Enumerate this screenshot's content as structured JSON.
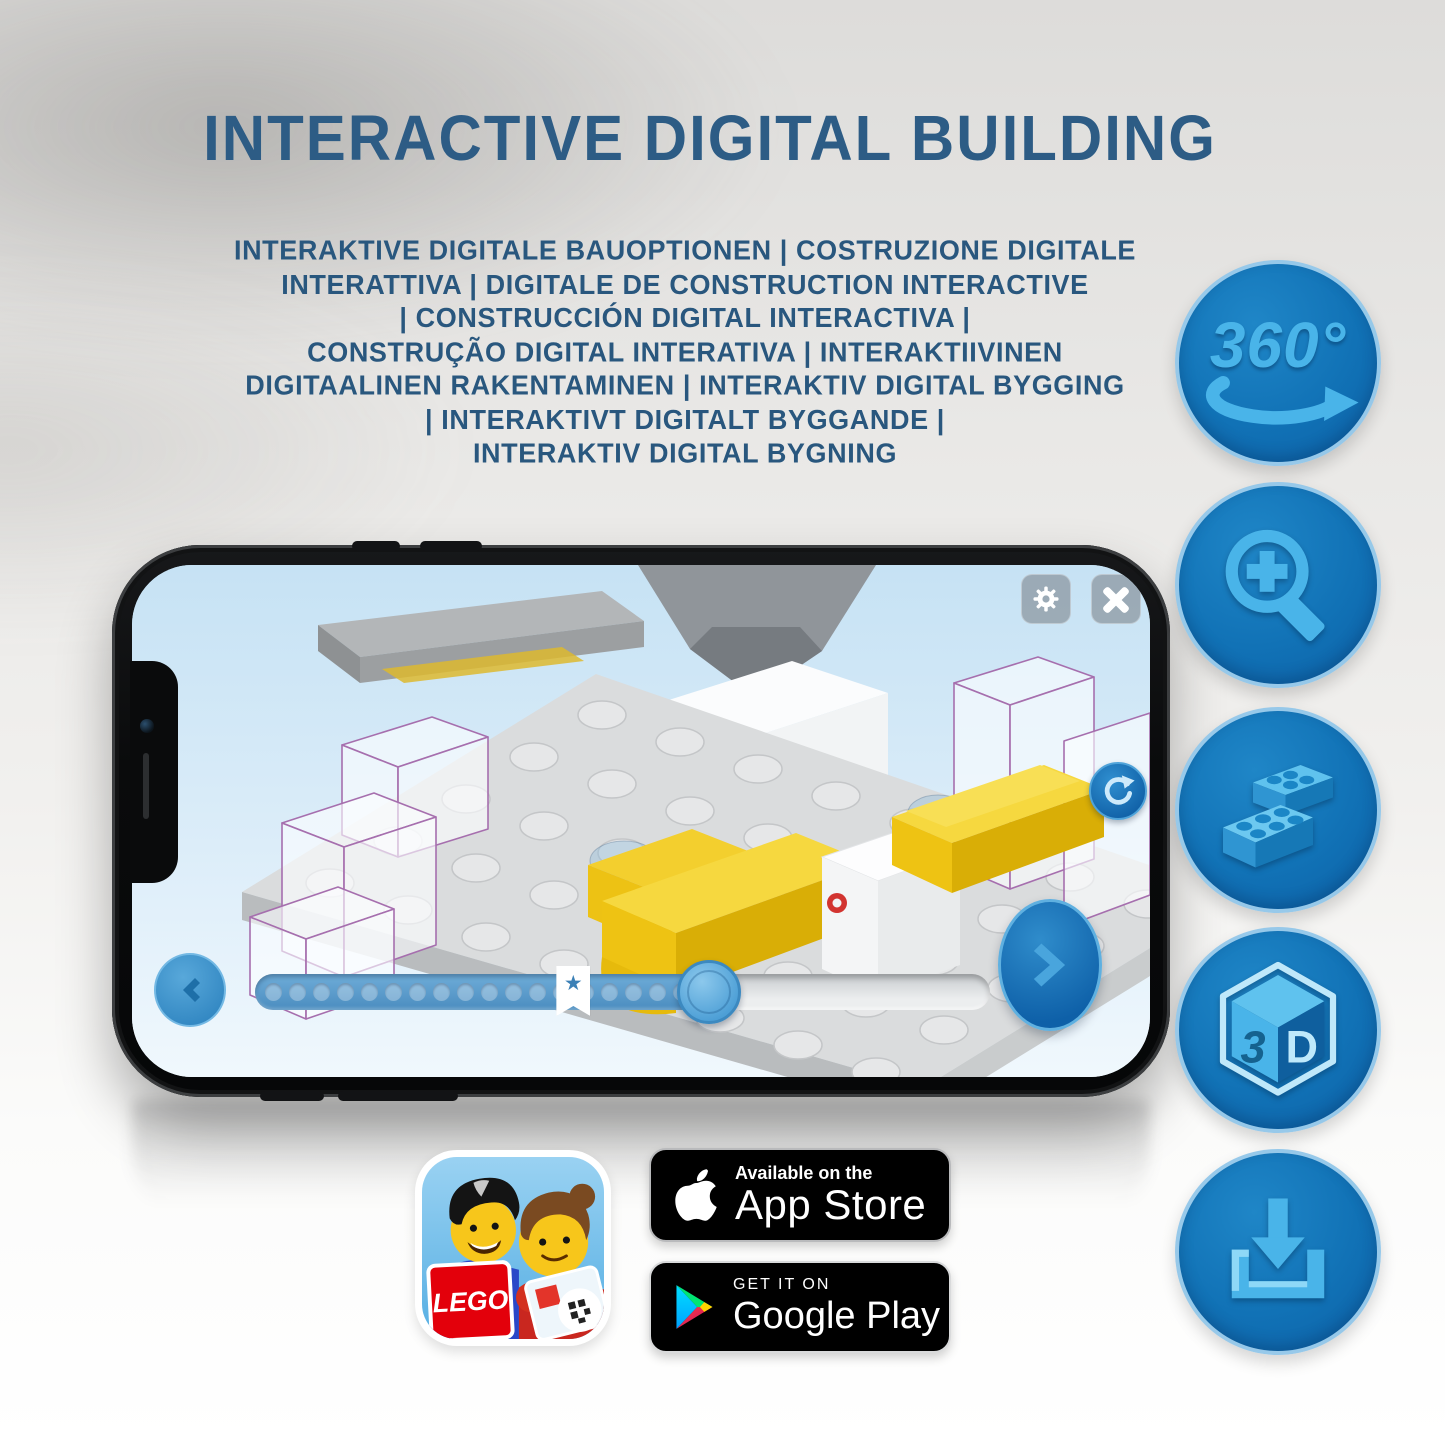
{
  "page": {
    "title": "INTERACTIVE DIGITAL BUILDING"
  },
  "subtitle": {
    "lines": [
      "INTERAKTIVE DIGITALE BAUOPTIONEN | COSTRUZIONE DIGITALE",
      "INTERATTIVA | DIGITALE DE CONSTRUCTION INTERACTIVE",
      "| CONSTRUCCIÓN DIGITAL INTERACTIVA |",
      "CONSTRUÇÃO DIGITAL INTERATIVA | INTERAKTIIVINEN",
      "DIGITAALINEN RAKENTAMINEN | INTERAKTIV DIGITAL BYGGING",
      "| INTERAKTIVT DIGITALT BYGGANDE |",
      "INTERAKTIV DIGITAL BYGNING"
    ]
  },
  "features": {
    "rotate_360_label": "360°",
    "cube_left_label": "3",
    "cube_right_label": "D",
    "icon_names": [
      "360-rotation-icon",
      "magnifier-zoom-in-icon",
      "lego-bricks-icon",
      "3d-cube-icon",
      "download-icon"
    ]
  },
  "phone": {
    "ui": {
      "icons": {
        "settings": "gear-icon",
        "close": "close-x-icon",
        "rotate": "rotate-arrow-icon",
        "previous": "chevron-left-icon",
        "next": "chevron-right-icon",
        "bookmark": "star-icon"
      },
      "progress": {
        "fill_percent": 62,
        "bookmark_percent": 41,
        "dot_count": 18
      }
    }
  },
  "badges": {
    "app_store": {
      "line1": "Available on the",
      "line2": "App Store"
    },
    "google_play": {
      "line1": "GET IT ON",
      "line2": "Google Play"
    },
    "lego_app": {
      "logo_text": "LEGO"
    }
  },
  "colors": {
    "heading_blue": "#2d5c85",
    "badge_circle_blue": "#1172b6",
    "icon_light_blue": "#49b4e9",
    "lego_yellow": "#f2cb1e",
    "lego_red": "#e3000b",
    "screen_sky_blue": "#cde6f5",
    "slider_fill_blue": "#5598c9"
  }
}
